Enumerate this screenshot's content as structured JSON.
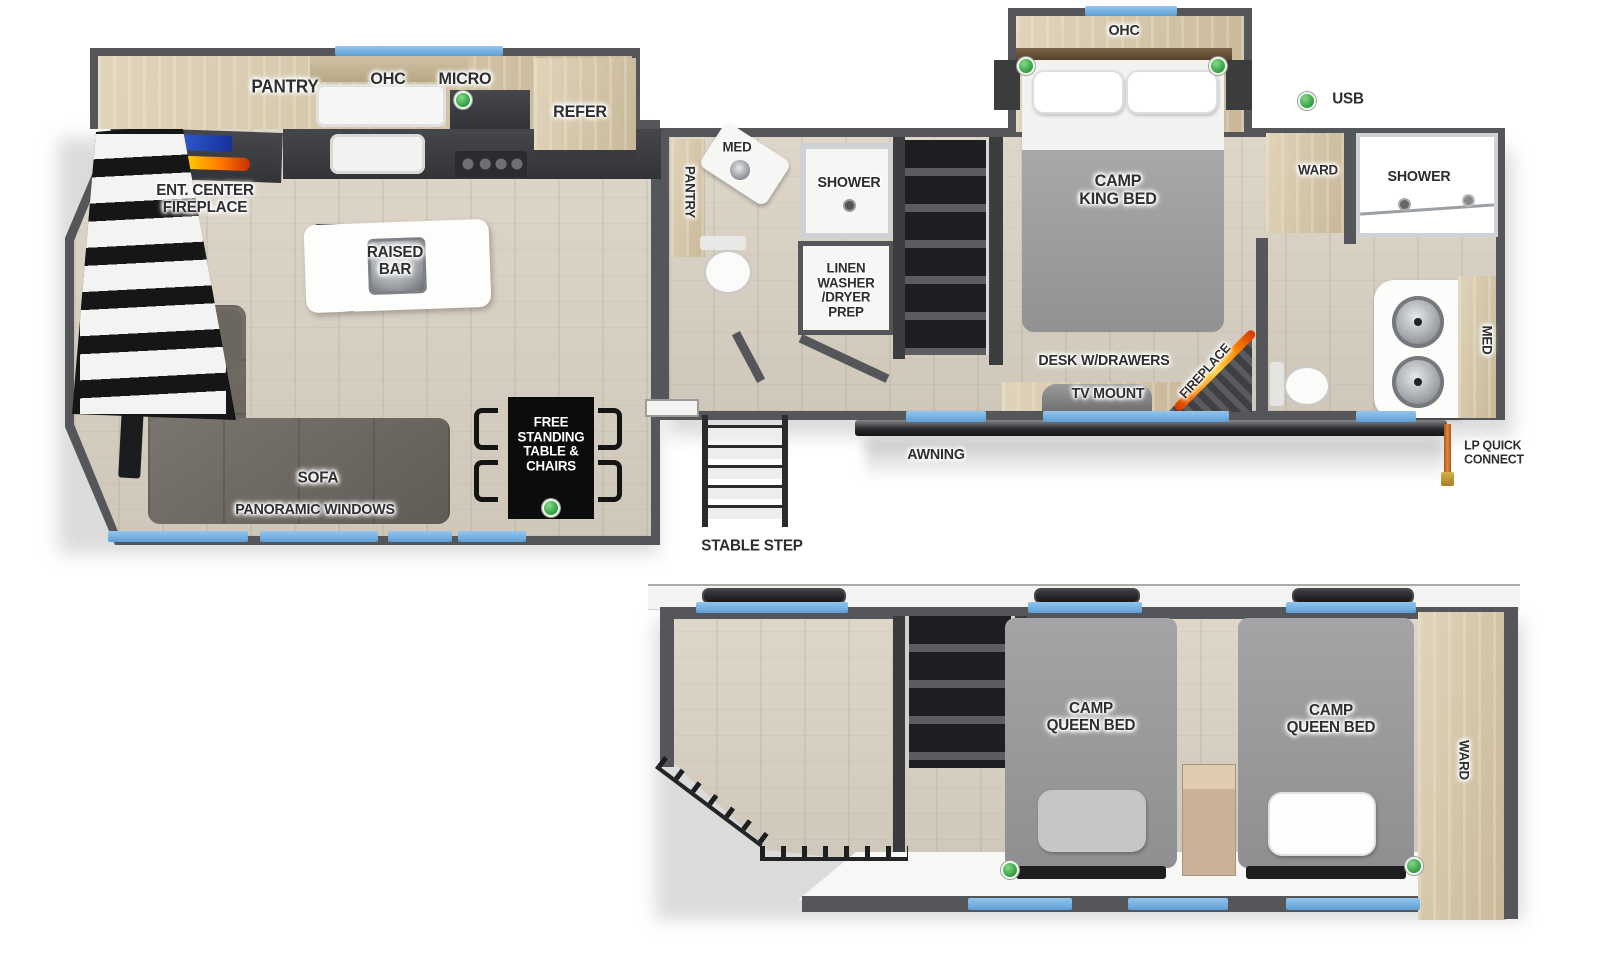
{
  "type": "rv-floorplan-two-level",
  "colors": {
    "wall": "#55565a",
    "wood_floor": "#d7d0c3",
    "cabinet_wood": "#d6c6a5",
    "window_blue": "#79b4e3",
    "indicator_green": "#3fae49",
    "awning_dark": "#26272a",
    "flame_orange": "#ff8a00",
    "lp_hose_orange": "#c8782e",
    "label_text": "#2e2e30"
  },
  "legend": {
    "usb": "USB"
  },
  "main_floor": {
    "kitchen": {
      "pantry": "PANTRY",
      "ohc": "OHC",
      "micro": "MICRO",
      "refer": "REFER",
      "ent_center": "ENT. CENTER\nFIREPLACE",
      "raised_bar": "RAISED\nBAR"
    },
    "living": {
      "sofa": "SOFA",
      "panoramic_windows": "PANORAMIC WINDOWS",
      "dinette": "FREE\nSTANDING\nTABLE &\nCHAIRS"
    },
    "entry": {
      "stable_step": "STABLE STEP"
    },
    "mid_bath": {
      "pantry": "PANTRY",
      "med": "MED",
      "shower": "SHOWER",
      "linen": "LINEN\nWASHER\n/DRYER\nPREP"
    },
    "bedroom": {
      "camp_king_bed": "CAMP\nKING BED",
      "ohc": "OHC",
      "ward": "WARD",
      "desk": "DESK W/DRAWERS",
      "tv_mount": "TV MOUNT",
      "fireplace": "FIREPLACE"
    },
    "rear_bath": {
      "shower": "SHOWER",
      "med": "MED"
    },
    "exterior": {
      "awning": "AWNING",
      "lp_quick_connect": "LP QUICK\nCONNECT"
    }
  },
  "loft": {
    "camp_queen_bed_1": "CAMP\nQUEEN BED",
    "camp_queen_bed_2": "CAMP\nQUEEN BED",
    "ward": "WARD"
  }
}
